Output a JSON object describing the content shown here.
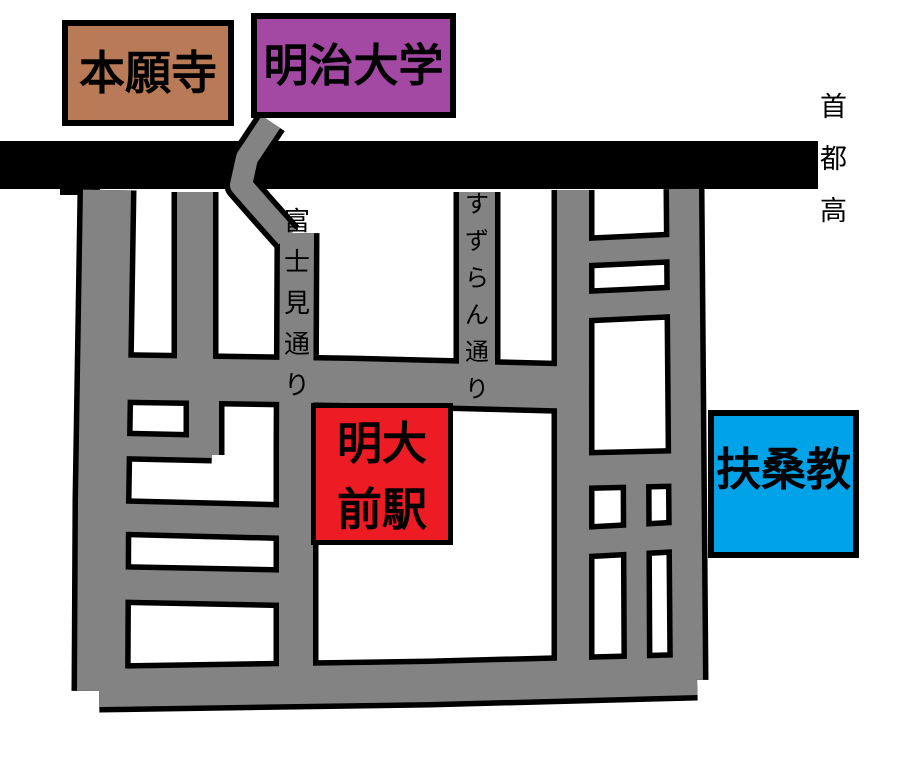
{
  "map": {
    "background_color": "#FFFFFF",
    "road_color": "#838383",
    "road_outline_color": "#000000",
    "expressway": {
      "label": "首都高",
      "bar_color": "#000000"
    },
    "streets": {
      "fujimi": {
        "label": "富士見通り"
      },
      "suzuran": {
        "label": "すずらん通り"
      }
    },
    "landmarks": {
      "honganji": {
        "label": "本願寺",
        "color": "#B97A57"
      },
      "meiji_university": {
        "label": "明治大学",
        "color": "#A349A4"
      },
      "meidaimae_station": {
        "label": "明大前駅",
        "display": "明大\n前駅",
        "color": "#ED1C24"
      },
      "fusokyo": {
        "label": "扶桑教",
        "color": "#00A2E8"
      }
    }
  }
}
